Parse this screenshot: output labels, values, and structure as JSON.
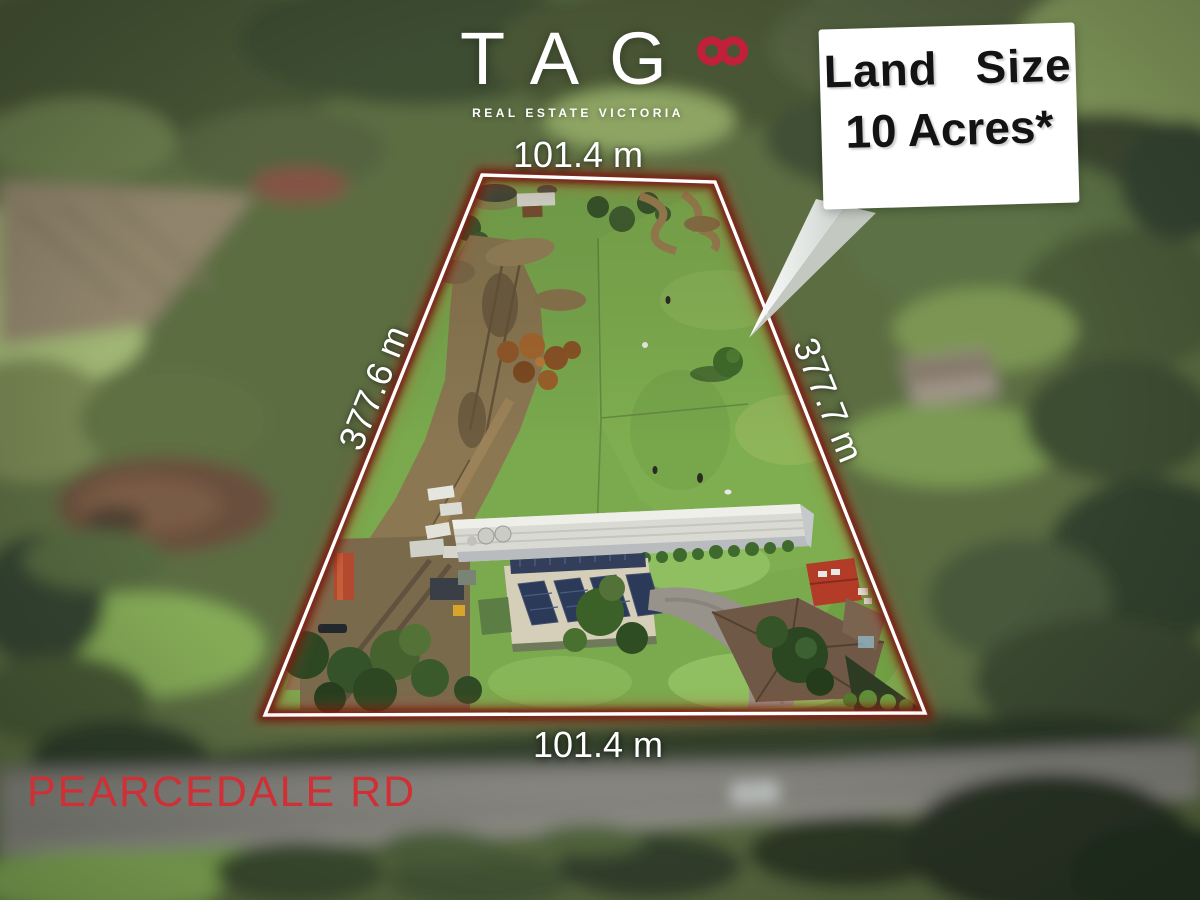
{
  "brand": {
    "name": "TAG",
    "tagline": "REAL ESTATE VICTORIA",
    "infinity_icon_color": "#c0203a"
  },
  "callout": {
    "line1": "Land Size",
    "line2": "10 Acres*",
    "background": "#ffffff",
    "text_color": "#131313"
  },
  "dimensions": {
    "top": "101.4 m",
    "bottom": "101.4 m",
    "left": "377.6 m",
    "right": "377.7 m",
    "label_color": "#ffffff"
  },
  "road": {
    "name": "PEARCEDALE RD",
    "label_color": "#d02f36"
  },
  "boundary": {
    "line_color": "#ffffff",
    "glow_color": "#6b1a10"
  }
}
